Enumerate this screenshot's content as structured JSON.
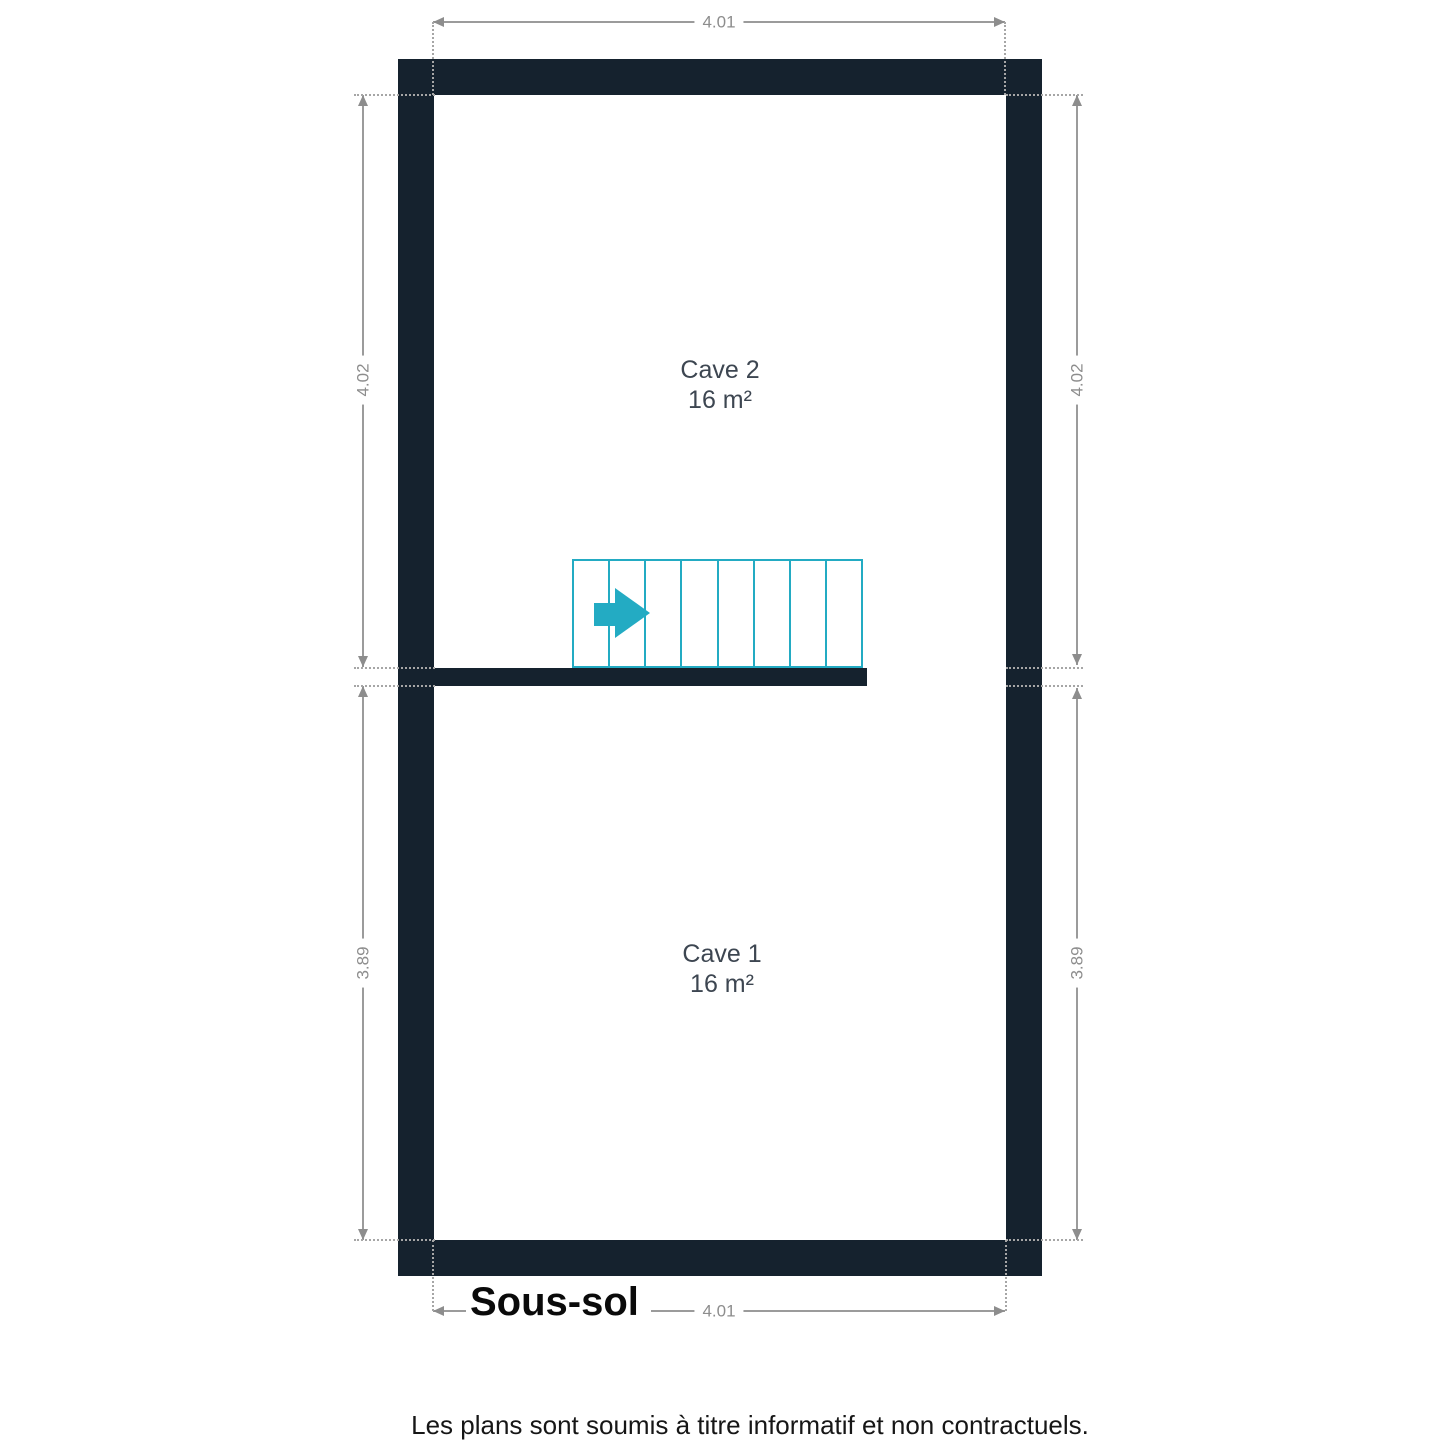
{
  "plan": {
    "floor_title": "Sous-sol",
    "disclaimer": "Les plans sont soumis à titre informatif et non contractuels."
  },
  "rooms": {
    "cave2": {
      "name": "Cave 2",
      "area": "16 m²"
    },
    "cave1": {
      "name": "Cave 1",
      "area": "16 m²"
    }
  },
  "dimensions": {
    "top": "4.01",
    "bottom": "4.01",
    "left_upper": "4.02",
    "left_lower": "3.89",
    "right_upper": "4.02",
    "right_lower": "3.89"
  },
  "stairs": {
    "steps": 8,
    "direction_icon": "arrow-right"
  },
  "colors": {
    "wall": "#15222e",
    "stairs": "#23abc3",
    "dimension_line": "#9b9b9b",
    "dimension_text": "#8d8d8d",
    "room_label": "#3d4651",
    "title_text": "#0a0a0a",
    "disclaimer_text": "#161616"
  }
}
